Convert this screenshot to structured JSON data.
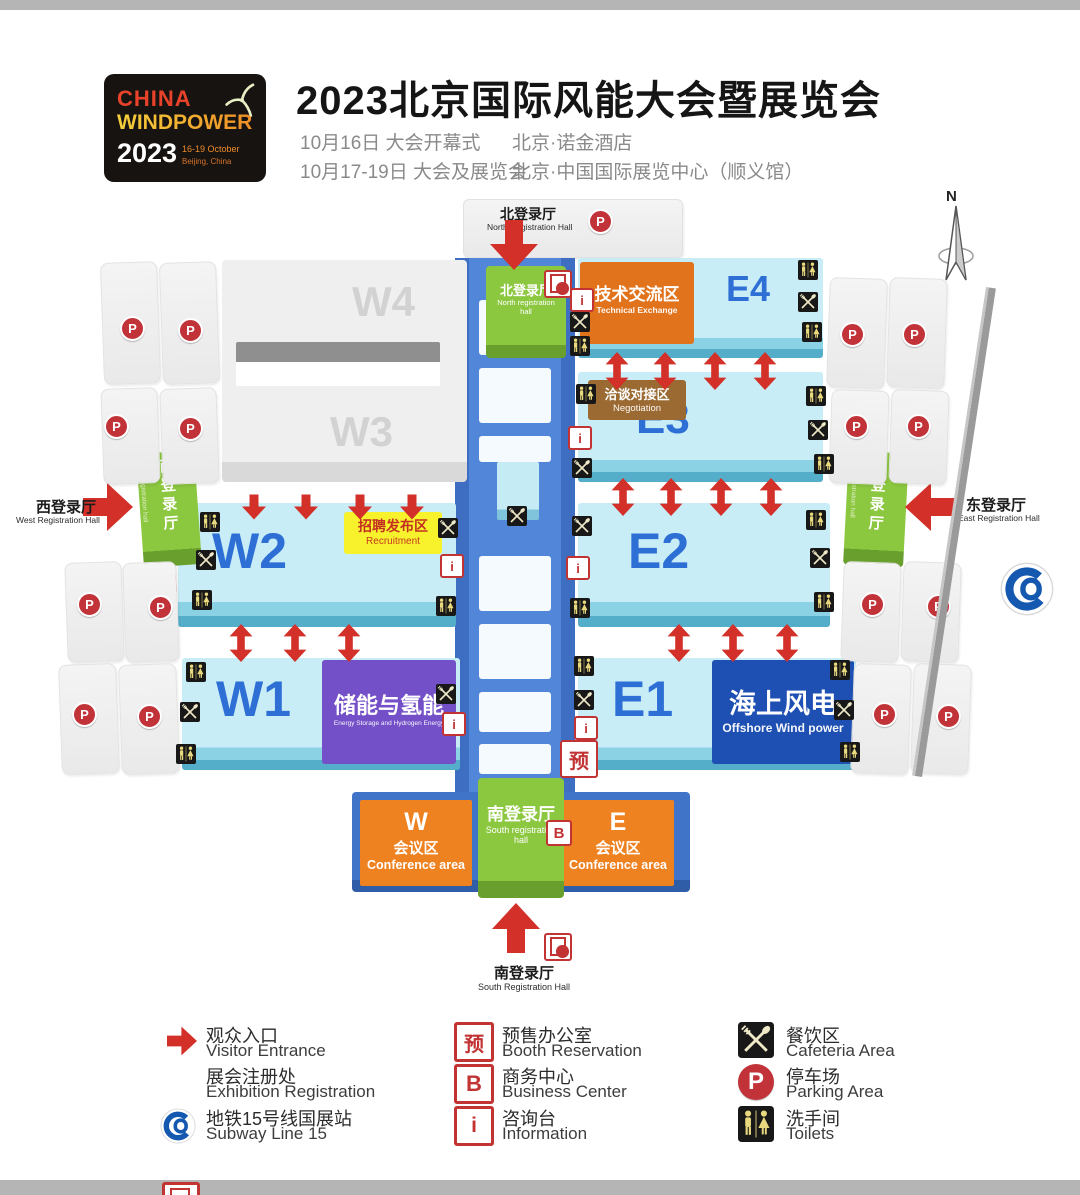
{
  "header": {
    "logo": {
      "china": "CHINA",
      "windpower": "WINDPOWER",
      "year": "2023",
      "dates": "16-19 October",
      "city": "Beijing, China"
    },
    "title": "2023北京国际风能大会暨展览会",
    "schedule": [
      {
        "left": "10月16日  大会开幕式",
        "right": "北京·诺金酒店"
      },
      {
        "left": "10月17-19日  大会及展览会",
        "right": "北京·中国国际展览中心（顺义馆）"
      }
    ]
  },
  "map": {
    "compass": "N",
    "north_label": {
      "zh": "北登录厅",
      "en": "North Registration Hall"
    },
    "north_hall": {
      "zh": "北登录厅",
      "en": "North registration hall"
    },
    "south_label": {
      "zh": "南登录厅",
      "en": "South Registration Hall"
    },
    "south_hall": {
      "zh": "南登录厅",
      "en": "South registration hall"
    },
    "west_label": {
      "zh": "西登录厅",
      "en": "West Registration Hall"
    },
    "west_hall": {
      "zh": "西登录厅",
      "en": "West registration hall"
    },
    "east_label": {
      "zh": "东登录厅",
      "en": "East Registration Hall"
    },
    "east_hall": {
      "zh": "东登录厅",
      "en": "East registration hall"
    },
    "halls": {
      "w1": "W1",
      "w2": "W2",
      "w3": "W3",
      "w4": "W4",
      "e1": "E1",
      "e2": "E2",
      "e3": "E3",
      "e4": "E4"
    },
    "zones": {
      "technical": {
        "zh": "技术交流区",
        "en": "Technical Exchange"
      },
      "negotiation": {
        "zh": "洽谈对接区",
        "en": "Negotiation"
      },
      "recruitment": {
        "zh": "招聘发布区",
        "en": "Recruitment"
      },
      "storage": {
        "zh": "储能与氢能",
        "en": "Energy Storage and Hydrogen Energy"
      },
      "offshore": {
        "zh": "海上风电",
        "en": "Offshore Wind power"
      },
      "conf_w": {
        "letter": "W",
        "zh": "会议区",
        "en": "Conference  area"
      },
      "conf_e": {
        "letter": "E",
        "zh": "会议区",
        "en": "Conference  area"
      }
    }
  },
  "icons": {
    "parking": "P",
    "business": "B",
    "booth": "预",
    "info": "i"
  },
  "legend": [
    {
      "zh": "观众入口",
      "en": "Visitor Entrance"
    },
    {
      "zh": "展会注册处",
      "en": "Exhibition Registration"
    },
    {
      "zh": "地铁15号线国展站",
      "en": "Subway Line 15"
    },
    {
      "zh": "预售办公室",
      "en": "Booth Reservation"
    },
    {
      "zh": "商务中心",
      "en": "Business Center"
    },
    {
      "zh": "咨询台",
      "en": "Information"
    },
    {
      "zh": "餐饮区",
      "en": "Cafeteria Area"
    },
    {
      "zh": "停车场",
      "en": "Parking Area"
    },
    {
      "zh": "洗手间",
      "en": "Toilets"
    }
  ]
}
